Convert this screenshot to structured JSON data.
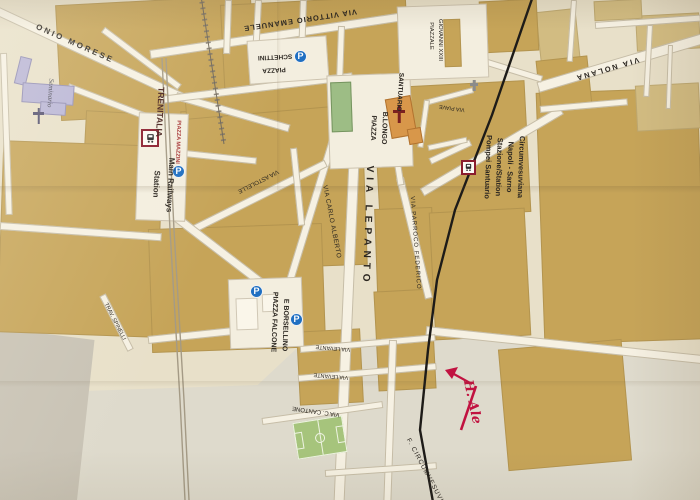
{
  "streets": {
    "onio_morese": "ONIO MORESE",
    "vittorio_emanuele": "VIA VITTORIO EMANUELE",
    "nolana": "VIA NOLANA",
    "lepanto": "VIA LEPANTO",
    "carlo_alberto": "VIA CARLO ALBERTO",
    "parroco_federico": "VIA PARROCO FEDERICO",
    "astolelle": "VIA ASTOLELLE",
    "piave": "VIA PIAVE",
    "levante": "VIA LEVANTE",
    "cantone": "VIA C. CANTONE",
    "spinelli": "TRAV. SPINELLI",
    "ferrovia_circum": "F. CIRCUMVESUVIANA"
  },
  "places": {
    "seminario": "Seminario",
    "santuario": "SANTUARIO",
    "piazza": "PIAZZA",
    "schettini": "SCHETTINI",
    "piazzale": "PIAZZALE",
    "giovanni": "GIOVANNI XXIII",
    "blongo": "B.LONGO",
    "falcone": "PIAZZA FALCONE",
    "borsellino": "E BORSELLINO",
    "mazzini": "PIAZZA MAZZINI"
  },
  "transport": {
    "trenitalia": "TRENITALIA",
    "main_railways": "Main Railways",
    "station": "Station",
    "circum1": "Circumvesuviana",
    "circum2": "Napoli - Sarno",
    "circum3": "Stazione/Station",
    "circum4": "Pompei Santuario",
    "parking": "P"
  },
  "annotation": {
    "handwriting": "H. Ale"
  },
  "colors": {
    "block_tan": "#c6a458",
    "road_white": "#f6f1e3",
    "rail_black": "#1d1b18",
    "parking_blue": "#1f6fc2",
    "station_red": "#8b1d2d",
    "park_green": "#9dbd85",
    "field_green": "#a6c47c",
    "lavender": "#b9b5d6",
    "church_orange": "#d8974a",
    "handwriting_red": "#c11240"
  }
}
